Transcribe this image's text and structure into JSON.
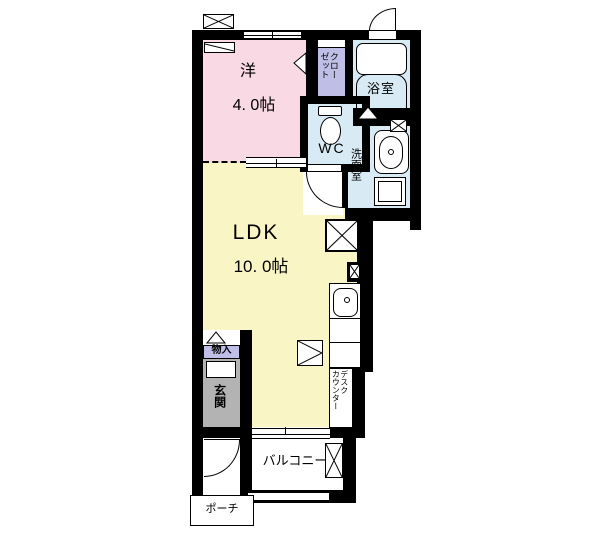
{
  "title": "apartment-floor-plan",
  "rooms": {
    "western": {
      "name": "洋",
      "size": "4. 0帖"
    },
    "ldk": {
      "name": "LDK",
      "size": "10. 0帖"
    },
    "wc": {
      "name": "WC"
    },
    "bath": {
      "name": "浴室"
    },
    "washroom": {
      "name": "洗面室"
    },
    "closet": {
      "line1": "クロー",
      "line2": "ゼット"
    },
    "storage": {
      "name": "物入"
    },
    "entrance": {
      "name": "玄関"
    },
    "balcony": {
      "name": "バルコニー"
    },
    "porch": {
      "name": "ポーチ"
    },
    "desk_counter": {
      "line1": "デスク",
      "line2": "カウンター"
    }
  },
  "colors": {
    "wall": "#000000",
    "western_room": "#F9D9E3",
    "ldk": "#FAF5C4",
    "wet_area": "#D8EAF4",
    "closet": "#BFBEE6",
    "entrance_floor": "#B3B3B3",
    "background": "#FFFFFF"
  },
  "icons": {
    "vent_window": "crossed-box",
    "bathtub": "rounded-rectangle",
    "toilet": "tank-and-bowl",
    "vanity_sink": "oval-basin",
    "washer_space": "nested-square",
    "refrigerator_space": "crossed-box",
    "pipe_space": "black-box-with-cross",
    "door_swing": "quarter-arc",
    "sliding_window": "double-line",
    "folding_door": "triangle"
  }
}
